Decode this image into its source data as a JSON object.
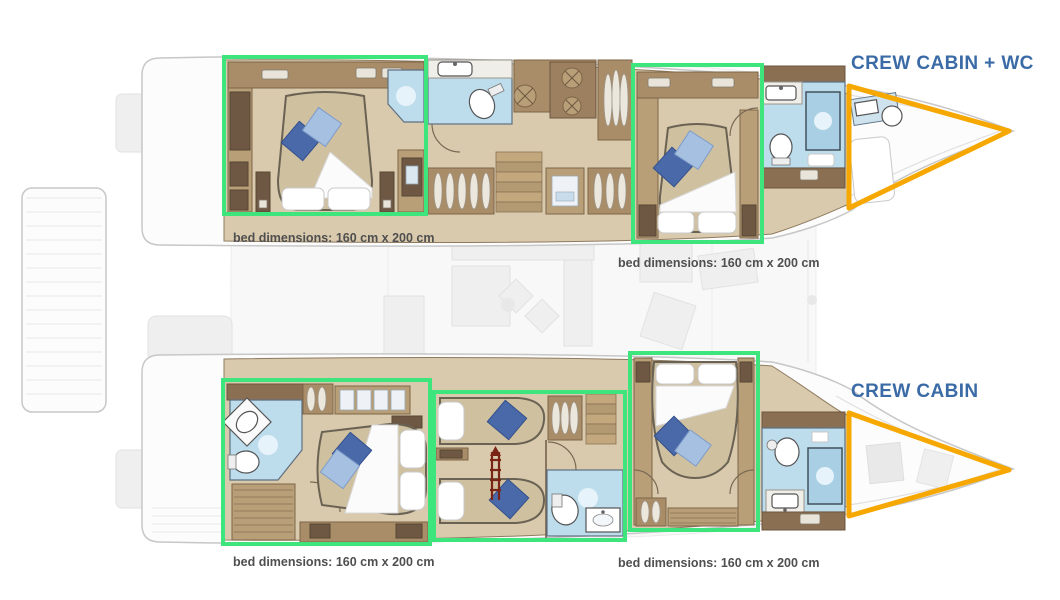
{
  "plan_title": "catamaran-cabin-layout",
  "crew_labels": {
    "top": "CREW CABIN + WC",
    "bottom": "CREW CABIN"
  },
  "captions": [
    {
      "prefix": "bed dimensions:",
      "value": "160 cm x 200 cm"
    },
    {
      "prefix": "bed dimensions:",
      "value": "160 cm x 200 cm"
    },
    {
      "prefix": "bed dimensions:",
      "value": "160 cm x 200 cm"
    },
    {
      "prefix": "bed dimensions:",
      "value": "160 cm x 200 cm"
    }
  ],
  "colors": {
    "highlight_green": "#3ee57d",
    "crew_orange": "#f6a800",
    "label_blue": "#3b6ba6",
    "caption_gray": "#4f4f4f"
  }
}
